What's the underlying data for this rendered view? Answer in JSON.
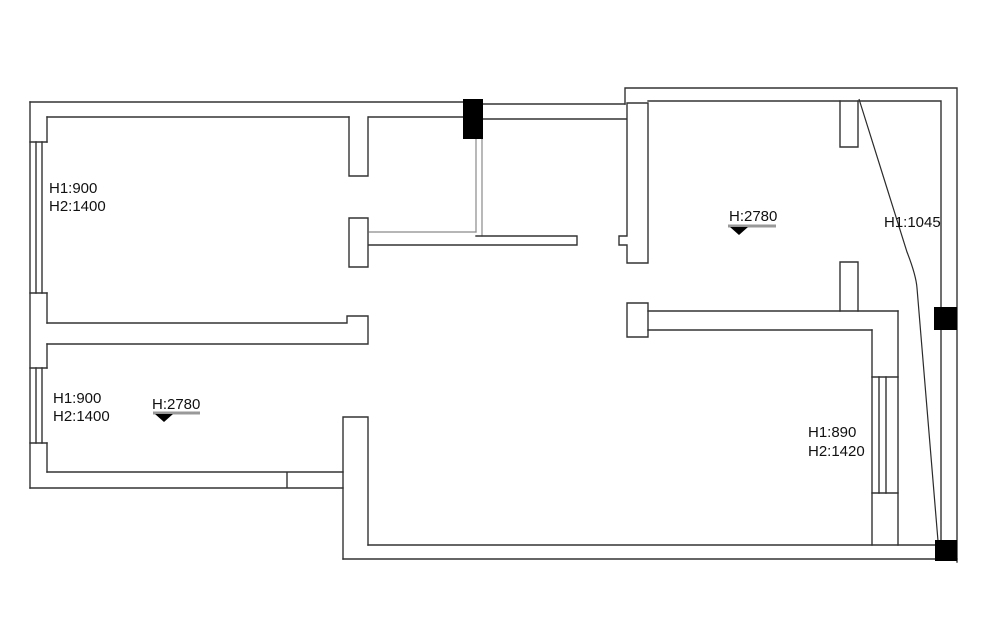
{
  "drawing": {
    "type": "apartment-floor-plan",
    "annotations": {
      "window_top_left": {
        "line1": "H1:900",
        "line2": "H2:1400"
      },
      "window_bottom_left": {
        "line1": "H1:900",
        "line2": "H2:1400"
      },
      "level_top_right": {
        "label": "H:2780"
      },
      "level_bottom_left": {
        "label": "H:2780"
      },
      "slope_height": {
        "label": "H1:1045"
      },
      "window_right": {
        "line1": "H1:890",
        "line2": "H2:1420"
      }
    },
    "colors": {
      "background": "#ffffff",
      "wall": "#333333",
      "wall_gray": "#8a8a8a",
      "column": "#000000",
      "marker_bar": "#999999",
      "text": "#111111"
    }
  }
}
